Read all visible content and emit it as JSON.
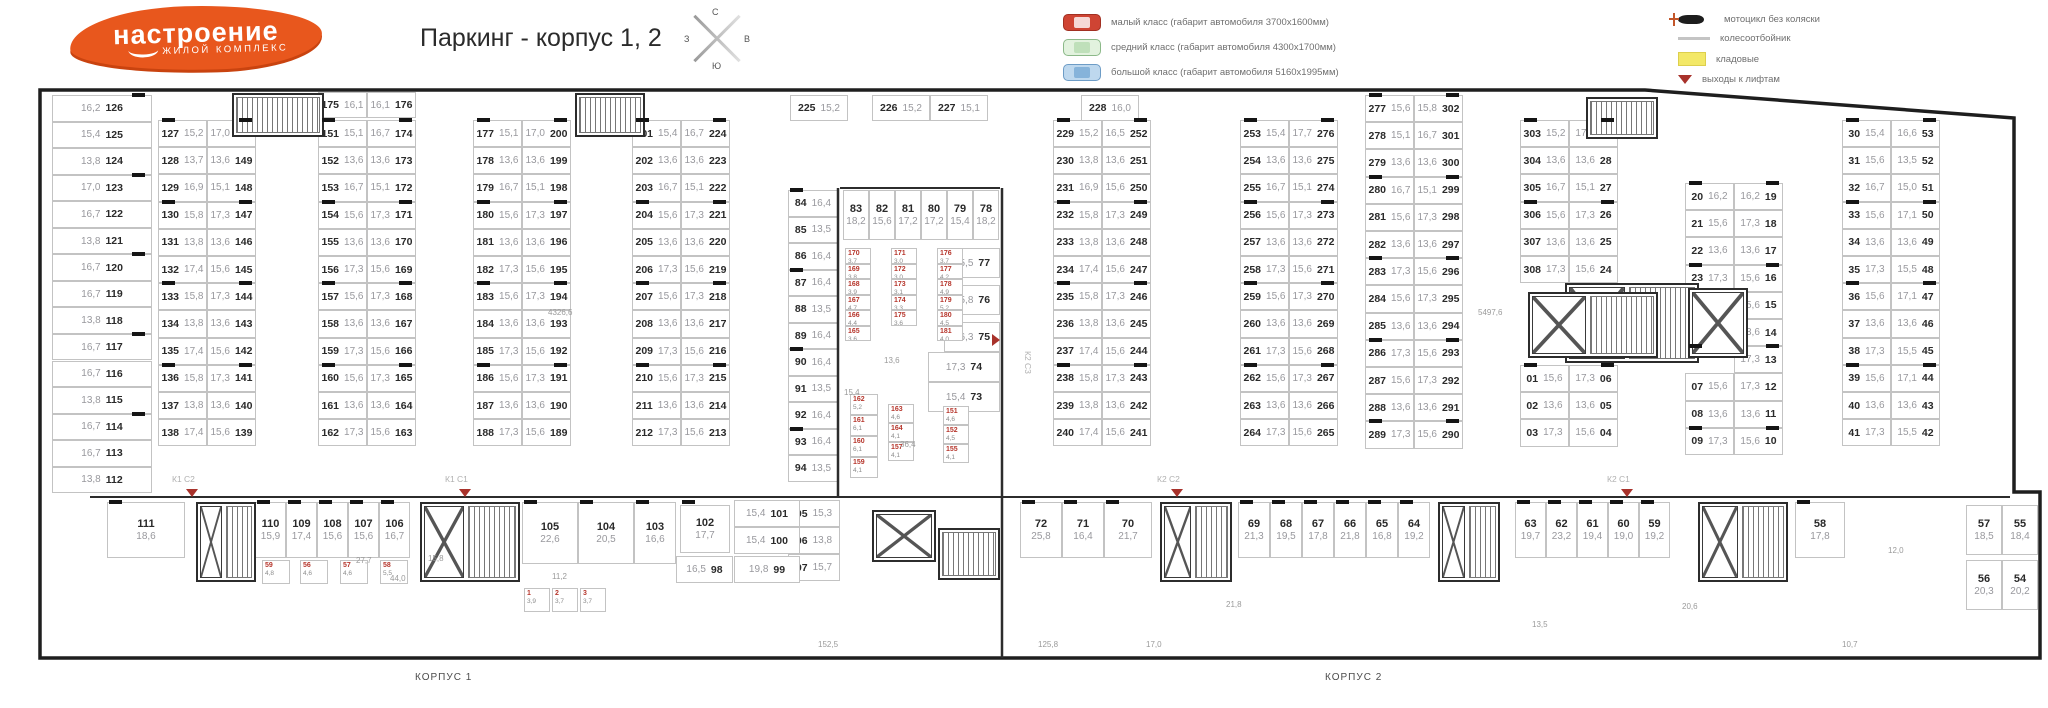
{
  "header": {
    "logo_line1": "настроение",
    "logo_line2": "жилой комплекс",
    "title": "Паркинг - корпус 1, 2",
    "compass": {
      "n": "С",
      "e": "В",
      "s": "Ю",
      "w": "З"
    }
  },
  "legend": {
    "left": [
      {
        "icon": "car-small-red-icon",
        "label": "малый класс (габарит автомобиля 3700х1600мм)"
      },
      {
        "icon": "car-medium-green-icon",
        "label": "средний класс (габарит автомобиля 4300х1700мм)"
      },
      {
        "icon": "car-large-blue-icon",
        "label": "большой класс (габарит автомобиля 5160х1995мм)"
      }
    ],
    "right": [
      {
        "icon": "motorcycle-icon",
        "label": "мотоцикл без коляски"
      },
      {
        "icon": "wheel-stop-icon",
        "label": "колесоотбойник"
      },
      {
        "icon": "storage-icon",
        "label": "кладовые"
      },
      {
        "icon": "exit-triangle-icon",
        "label": "выходы к лифтам"
      }
    ]
  },
  "plan": {
    "left_column": [
      [
        "16,2",
        "126"
      ],
      [
        "15,4",
        "125"
      ],
      [
        "13,8",
        "124"
      ],
      [
        "17,0",
        "123"
      ],
      [
        "16,7",
        "122"
      ],
      [
        "13,8",
        "121"
      ],
      [
        "16,7",
        "120"
      ],
      [
        "16,7",
        "119"
      ],
      [
        "13,8",
        "118"
      ],
      [
        "16,7",
        "117"
      ],
      [
        "16,7",
        "116"
      ],
      [
        "13,8",
        "115"
      ],
      [
        "16,7",
        "114"
      ],
      [
        "16,7",
        "113"
      ],
      [
        "13,8",
        "112"
      ]
    ],
    "pairs": {
      "A": [
        [
          "127",
          "15,2",
          "17,0",
          "150"
        ],
        [
          "128",
          "13,7",
          "13,6",
          "149"
        ],
        [
          "129",
          "16,9",
          "15,1",
          "148"
        ],
        [
          "130",
          "15,8",
          "17,3",
          "147"
        ],
        [
          "131",
          "13,8",
          "13,6",
          "146"
        ],
        [
          "132",
          "17,4",
          "15,6",
          "145"
        ],
        [
          "133",
          "15,8",
          "17,3",
          "144"
        ],
        [
          "134",
          "13,8",
          "13,6",
          "143"
        ],
        [
          "135",
          "17,4",
          "15,6",
          "142"
        ],
        [
          "136",
          "15,8",
          "17,3",
          "141"
        ],
        [
          "137",
          "13,8",
          "13,6",
          "140"
        ],
        [
          "138",
          "17,4",
          "15,6",
          "139"
        ]
      ],
      "Bh": [
        [
          "175",
          "16,1",
          "16,1",
          "176"
        ]
      ],
      "B": [
        [
          "151",
          "15,1",
          "16,7",
          "174"
        ],
        [
          "152",
          "13,6",
          "13,6",
          "173"
        ],
        [
          "153",
          "16,7",
          "15,1",
          "172"
        ],
        [
          "154",
          "15,6",
          "17,3",
          "171"
        ],
        [
          "155",
          "13,6",
          "13,6",
          "170"
        ],
        [
          "156",
          "17,3",
          "15,6",
          "169"
        ],
        [
          "157",
          "15,6",
          "17,3",
          "168"
        ],
        [
          "158",
          "13,6",
          "13,6",
          "167"
        ],
        [
          "159",
          "17,3",
          "15,6",
          "166"
        ],
        [
          "160",
          "15,6",
          "17,3",
          "165"
        ],
        [
          "161",
          "13,6",
          "13,6",
          "164"
        ],
        [
          "162",
          "17,3",
          "15,6",
          "163"
        ]
      ],
      "C": [
        [
          "177",
          "15,1",
          "17,0",
          "200"
        ],
        [
          "178",
          "13,6",
          "13,6",
          "199"
        ],
        [
          "179",
          "16,7",
          "15,1",
          "198"
        ],
        [
          "180",
          "15,6",
          "17,3",
          "197"
        ],
        [
          "181",
          "13,6",
          "13,6",
          "196"
        ],
        [
          "182",
          "17,3",
          "15,6",
          "195"
        ],
        [
          "183",
          "15,6",
          "17,3",
          "194"
        ],
        [
          "184",
          "13,6",
          "13,6",
          "193"
        ],
        [
          "185",
          "17,3",
          "15,6",
          "192"
        ],
        [
          "186",
          "15,6",
          "17,3",
          "191"
        ],
        [
          "187",
          "13,6",
          "13,6",
          "190"
        ],
        [
          "188",
          "17,3",
          "15,6",
          "189"
        ]
      ],
      "D": [
        [
          "201",
          "15,4",
          "16,7",
          "224"
        ],
        [
          "202",
          "13,6",
          "13,6",
          "223"
        ],
        [
          "203",
          "16,7",
          "15,1",
          "222"
        ],
        [
          "204",
          "15,6",
          "17,3",
          "221"
        ],
        [
          "205",
          "13,6",
          "13,6",
          "220"
        ],
        [
          "206",
          "17,3",
          "15,6",
          "219"
        ],
        [
          "207",
          "15,6",
          "17,3",
          "218"
        ],
        [
          "208",
          "13,6",
          "13,6",
          "217"
        ],
        [
          "209",
          "17,3",
          "15,6",
          "216"
        ],
        [
          "210",
          "15,6",
          "17,3",
          "215"
        ],
        [
          "211",
          "13,6",
          "13,6",
          "214"
        ],
        [
          "212",
          "17,3",
          "15,6",
          "213"
        ]
      ],
      "E": [
        [
          "229",
          "15,2",
          "16,5",
          "252"
        ],
        [
          "230",
          "13,8",
          "13,6",
          "251"
        ],
        [
          "231",
          "16,9",
          "15,6",
          "250"
        ],
        [
          "232",
          "15,8",
          "17,3",
          "249"
        ],
        [
          "233",
          "13,8",
          "13,6",
          "248"
        ],
        [
          "234",
          "17,4",
          "15,6",
          "247"
        ],
        [
          "235",
          "15,8",
          "17,3",
          "246"
        ],
        [
          "236",
          "13,8",
          "13,6",
          "245"
        ],
        [
          "237",
          "17,4",
          "15,6",
          "244"
        ],
        [
          "238",
          "15,8",
          "17,3",
          "243"
        ],
        [
          "239",
          "13,8",
          "13,6",
          "242"
        ],
        [
          "240",
          "17,4",
          "15,6",
          "241"
        ]
      ],
      "F": [
        [
          "253",
          "15,4",
          "17,7",
          "276"
        ],
        [
          "254",
          "13,6",
          "13,6",
          "275"
        ],
        [
          "255",
          "16,7",
          "15,1",
          "274"
        ],
        [
          "256",
          "15,6",
          "17,3",
          "273"
        ],
        [
          "257",
          "13,6",
          "13,6",
          "272"
        ],
        [
          "258",
          "17,3",
          "15,6",
          "271"
        ],
        [
          "259",
          "15,6",
          "17,3",
          "270"
        ],
        [
          "260",
          "13,6",
          "13,6",
          "269"
        ],
        [
          "261",
          "17,3",
          "15,6",
          "268"
        ],
        [
          "262",
          "15,6",
          "17,3",
          "267"
        ],
        [
          "263",
          "13,6",
          "13,6",
          "266"
        ],
        [
          "264",
          "17,3",
          "15,6",
          "265"
        ]
      ],
      "G": [
        [
          "277",
          "15,6",
          "15,8",
          "302"
        ],
        [
          "278",
          "15,1",
          "16,7",
          "301"
        ],
        [
          "279",
          "13,6",
          "13,6",
          "300"
        ],
        [
          "280",
          "16,7",
          "15,1",
          "299"
        ],
        [
          "281",
          "15,6",
          "17,3",
          "298"
        ],
        [
          "282",
          "13,6",
          "13,6",
          "297"
        ],
        [
          "283",
          "17,3",
          "15,6",
          "296"
        ],
        [
          "284",
          "15,6",
          "17,3",
          "295"
        ],
        [
          "285",
          "13,6",
          "13,6",
          "294"
        ],
        [
          "286",
          "17,3",
          "15,6",
          "293"
        ],
        [
          "287",
          "15,6",
          "17,3",
          "292"
        ],
        [
          "288",
          "13,6",
          "13,6",
          "291"
        ],
        [
          "289",
          "17,3",
          "15,6",
          "290"
        ]
      ],
      "H": [
        [
          "303",
          "15,2",
          "17,2",
          "29"
        ],
        [
          "304",
          "13,6",
          "13,6",
          "28"
        ],
        [
          "305",
          "16,7",
          "15,1",
          "27"
        ],
        [
          "306",
          "15,6",
          "17,3",
          "26"
        ],
        [
          "307",
          "13,6",
          "13,6",
          "25"
        ],
        [
          "308",
          "17,3",
          "15,6",
          "24"
        ]
      ],
      "H2": [
        [
          "01",
          "15,6",
          "17,3",
          "06"
        ],
        [
          "02",
          "13,6",
          "13,6",
          "05"
        ],
        [
          "03",
          "17,3",
          "15,6",
          "04"
        ]
      ],
      "I": [
        [
          "20",
          "16,2",
          "16,2",
          "19"
        ],
        [
          "21",
          "15,6",
          "17,3",
          "18"
        ],
        [
          "22",
          "13,6",
          "13,6",
          "17"
        ],
        [
          "23",
          "17,3",
          "15,6",
          "16"
        ],
        [
          null,
          null,
          "15,6",
          "15"
        ],
        [
          null,
          null,
          "13,6",
          "14"
        ],
        [
          null,
          null,
          "17,3",
          "13"
        ],
        [
          "07",
          "15,6",
          "17,3",
          "12"
        ],
        [
          "08",
          "13,6",
          "13,6",
          "11"
        ],
        [
          "09",
          "17,3",
          "15,6",
          "10"
        ]
      ],
      "J": [
        [
          "30",
          "15,4",
          "16,6",
          "53"
        ],
        [
          "31",
          "15,6",
          "13,5",
          "52"
        ],
        [
          "32",
          "16,7",
          "15,0",
          "51"
        ],
        [
          "33",
          "15,6",
          "17,1",
          "50"
        ],
        [
          "34",
          "13,6",
          "13,6",
          "49"
        ],
        [
          "35",
          "17,3",
          "15,5",
          "48"
        ],
        [
          "36",
          "15,6",
          "17,1",
          "47"
        ],
        [
          "37",
          "13,6",
          "13,6",
          "46"
        ],
        [
          "38",
          "17,3",
          "15,5",
          "45"
        ],
        [
          "39",
          "15,6",
          "17,1",
          "44"
        ],
        [
          "40",
          "13,6",
          "13,6",
          "43"
        ],
        [
          "41",
          "17,3",
          "15,5",
          "42"
        ]
      ]
    },
    "top_singles": [
      [
        "225",
        "15,2"
      ],
      [
        "226",
        "15,2"
      ],
      [
        "227",
        "15,1"
      ],
      [
        "228",
        "16,0"
      ]
    ],
    "core_left": [
      [
        "84",
        "16,4"
      ],
      [
        "85",
        "13,5"
      ],
      [
        "86",
        "16,4"
      ],
      [
        "87",
        "16,4"
      ],
      [
        "88",
        "13,5"
      ],
      [
        "89",
        "16,4"
      ],
      [
        "90",
        "16,4"
      ],
      [
        "91",
        "13,5"
      ],
      [
        "92",
        "16,4"
      ],
      [
        "93",
        "16,4"
      ],
      [
        "94",
        "13,5"
      ]
    ],
    "core_top": [
      [
        "83",
        "18,2"
      ],
      [
        "82",
        "15,6"
      ],
      [
        "81",
        "17,2"
      ],
      [
        "80",
        "17,2"
      ],
      [
        "79",
        "15,4"
      ],
      [
        "78",
        "18,2"
      ]
    ],
    "core_right": [
      [
        "15,5",
        "77"
      ],
      [
        "15,8",
        "76"
      ],
      [
        "16,3",
        "75"
      ],
      [
        "17,3",
        "74"
      ],
      [
        "15,4",
        "73"
      ]
    ],
    "col95": [
      [
        "95",
        "15,3"
      ],
      [
        "96",
        "13,8"
      ],
      [
        "97",
        "15,7"
      ]
    ],
    "corpus1": [
      [
        "111",
        "18,6"
      ],
      [
        "110",
        "15,9"
      ],
      [
        "109",
        "17,4"
      ],
      [
        "108",
        "15,6"
      ],
      [
        "107",
        "15,6"
      ],
      [
        "106",
        "16,7"
      ],
      [
        "105",
        "22,6"
      ],
      [
        "104",
        "20,5"
      ],
      [
        "103",
        "16,6"
      ],
      [
        "102",
        "17,7"
      ]
    ],
    "corpus1_extra": [
      [
        "15,4",
        "101"
      ],
      [
        "15,4",
        "100"
      ],
      [
        "16,5",
        "98"
      ],
      [
        "19,8",
        "99"
      ]
    ],
    "corpus2": [
      [
        "72",
        "25,8"
      ],
      [
        "71",
        "16,4"
      ],
      [
        "70",
        "21,7"
      ],
      [
        "69",
        "21,3"
      ],
      [
        "68",
        "19,5"
      ],
      [
        "67",
        "17,8"
      ],
      [
        "66",
        "21,8"
      ],
      [
        "65",
        "16,8"
      ],
      [
        "64",
        "19,2"
      ],
      [
        "63",
        "19,7"
      ],
      [
        "62",
        "23,2"
      ],
      [
        "61",
        "19,4"
      ],
      [
        "60",
        "19,0"
      ],
      [
        "59",
        "19,2"
      ],
      [
        "58",
        "17,8"
      ]
    ],
    "right_block": [
      [
        "57",
        "18,5"
      ],
      [
        "55",
        "18,4"
      ],
      [
        "56",
        "20,3"
      ],
      [
        "54",
        "20,2"
      ]
    ],
    "storage": {
      "stack_a": [
        [
          "170",
          "3,7"
        ],
        [
          "169",
          "3,8"
        ],
        [
          "168",
          "3,9"
        ],
        [
          "167",
          "4,7"
        ],
        [
          "166",
          "4,4"
        ],
        [
          "165",
          "3,6"
        ]
      ],
      "stack_b": [
        [
          "171",
          "3,0"
        ],
        [
          "172",
          "3,0"
        ],
        [
          "173",
          "3,1"
        ],
        [
          "174",
          "3,3"
        ],
        [
          "175",
          "3,6"
        ]
      ],
      "stack_c": [
        [
          "176",
          "3,7"
        ],
        [
          "177",
          "4,2"
        ],
        [
          "178",
          "4,9"
        ],
        [
          "179",
          "5,2"
        ],
        [
          "180",
          "4,5"
        ],
        [
          "181",
          "4,0"
        ]
      ],
      "stack_d": [
        [
          "162",
          "5,2"
        ],
        [
          "161",
          "6,1"
        ],
        [
          "160",
          "6,1"
        ],
        [
          "159",
          "4,1"
        ]
      ],
      "stack_e": [
        [
          "163",
          "4,6"
        ],
        [
          "164",
          "4,1"
        ],
        [
          "157",
          "4,1"
        ]
      ],
      "stack_f": [
        [
          "151",
          "4,6"
        ],
        [
          "152",
          "4,5"
        ],
        [
          "155",
          "4,1"
        ]
      ],
      "row_c1a": [
        [
          "59",
          "4,8"
        ],
        [
          "56",
          "4,6"
        ],
        [
          "57",
          "4,6"
        ],
        [
          "58",
          "5,5"
        ]
      ],
      "row_c1b": [
        [
          "1",
          "3,9"
        ],
        [
          "2",
          "3,7"
        ],
        [
          "3",
          "3,7"
        ]
      ]
    },
    "dimensions": [
      "4326,6",
      "5497,6",
      "27,7",
      "44,0",
      "15,8",
      "11,2",
      "21,8",
      "20,6",
      "152,5",
      "125,8",
      "17,0",
      "13,5",
      "10,7",
      "12,0",
      "15,4",
      "13,6",
      "36,4"
    ],
    "sections": [
      "К1 С2",
      "К1 С1",
      "К2 С2",
      "К2 С1",
      "К2 С3"
    ],
    "buildings": [
      "КОРПУС 1",
      "КОРПУС 2"
    ]
  }
}
